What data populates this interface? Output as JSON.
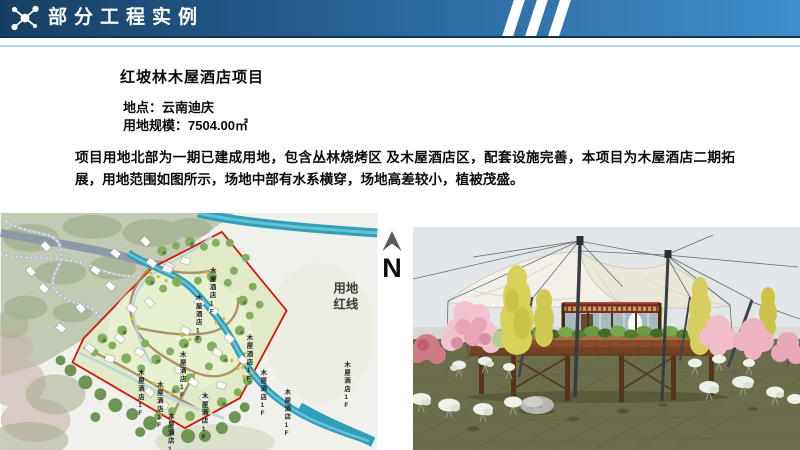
{
  "header": {
    "title": "部分工程实例",
    "icon": "molecule-network-icon",
    "colors": {
      "bar_left": "#173f63",
      "bar_right": "#3e8ecd",
      "stripes": "#ffffff",
      "rule": "#b3d2ec"
    }
  },
  "project": {
    "title": "红坡林木屋酒店项目",
    "location": "地点：云南迪庆",
    "land_area": "用地规模：7504.00㎡",
    "description": "项目用地北部为一期已建成用地，包含丛林烧烤区 及木屋酒店区，配套设施完善，本项目为木屋酒店二期拓展，用地范围如图所示，场地中部有水系横穿，场地高差较小，植被茂盛。"
  },
  "site_plan": {
    "north_label": "N",
    "boundary_label_line1": "用地",
    "boundary_label_line2": "红线",
    "cabin_label": "木屋酒店1F",
    "colors": {
      "boundary_red_line": "#d11510",
      "river": "#2f9fba",
      "site_green": "#e0eac6"
    }
  },
  "rendering": {
    "colors": {
      "sky": "#e3e6e8",
      "ground": "#6c6d4a",
      "canopy": "#f1efe6",
      "deck_wood": "#8a4a2c",
      "blossom": "#f2c3cf"
    }
  }
}
